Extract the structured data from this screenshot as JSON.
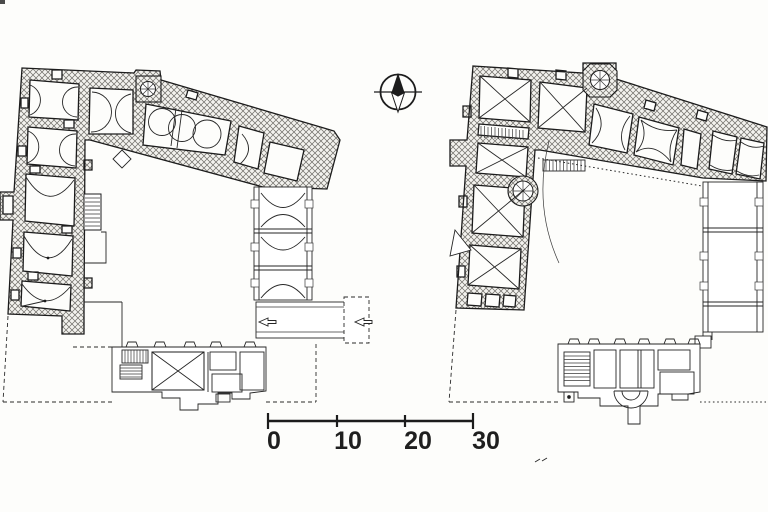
{
  "scale_bar": {
    "labels": [
      "0",
      "10",
      "20",
      "30"
    ],
    "ticks": 4,
    "unit_interval": 10
  },
  "north_indicator": {
    "icon": "compass-north-arrow"
  },
  "plans": {
    "left": {
      "id": "floor-plan-left"
    },
    "right": {
      "id": "floor-plan-right"
    }
  },
  "colors": {
    "ink": "#1c1c1c",
    "paper": "#fdfdfb",
    "hatch_line": "#72706b",
    "hatch_fill": "#f3f2ee"
  }
}
